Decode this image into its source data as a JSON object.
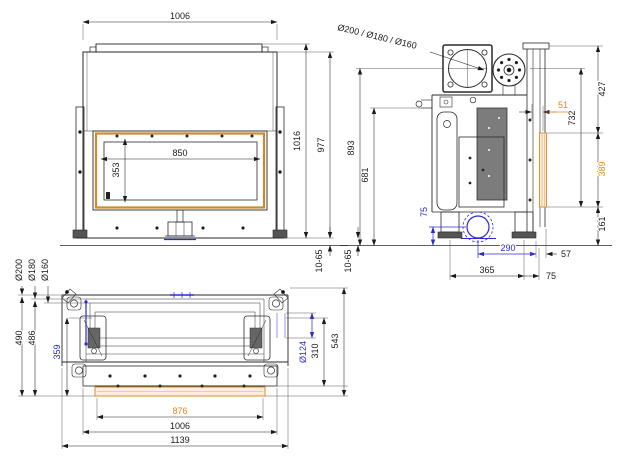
{
  "document": {
    "kind": "technical-dimension-drawing",
    "background": "#ffffff"
  },
  "colors": {
    "line": "#2a2a2a",
    "accent_orange": "#e8861e",
    "accent_blue": "#2b2bd0",
    "glass_fill": "#fbeedd",
    "glass_stroke": "#d98f2e"
  },
  "front_view": {
    "dim_1006": "1006",
    "dim_850": "850",
    "dim_353": "353",
    "dim_1016": "1016",
    "dim_977": "977",
    "dim_10_65": "10-65"
  },
  "side_view": {
    "flue_label": "Ø200 / Ø180 / Ø160",
    "dim_51": "51",
    "dim_427": "427",
    "dim_732": "732",
    "dim_389": "389",
    "dim_161": "161",
    "dim_893": "893",
    "dim_681": "681",
    "dim_75_intake": "75",
    "dim_290": "290",
    "dim_57": "57",
    "dim_365": "365",
    "dim_75_base": "75",
    "dim_10_65": "10-65"
  },
  "plan_view": {
    "dia_200": "Ø200",
    "dia_180": "Ø180",
    "dia_160": "Ø160",
    "dim_490": "490",
    "dim_486": "486",
    "dim_359": "359",
    "dim_124": "Ø124",
    "dim_310": "310",
    "dim_543": "543",
    "dim_876": "876",
    "dim_1006": "1006",
    "dim_1139": "1139"
  }
}
